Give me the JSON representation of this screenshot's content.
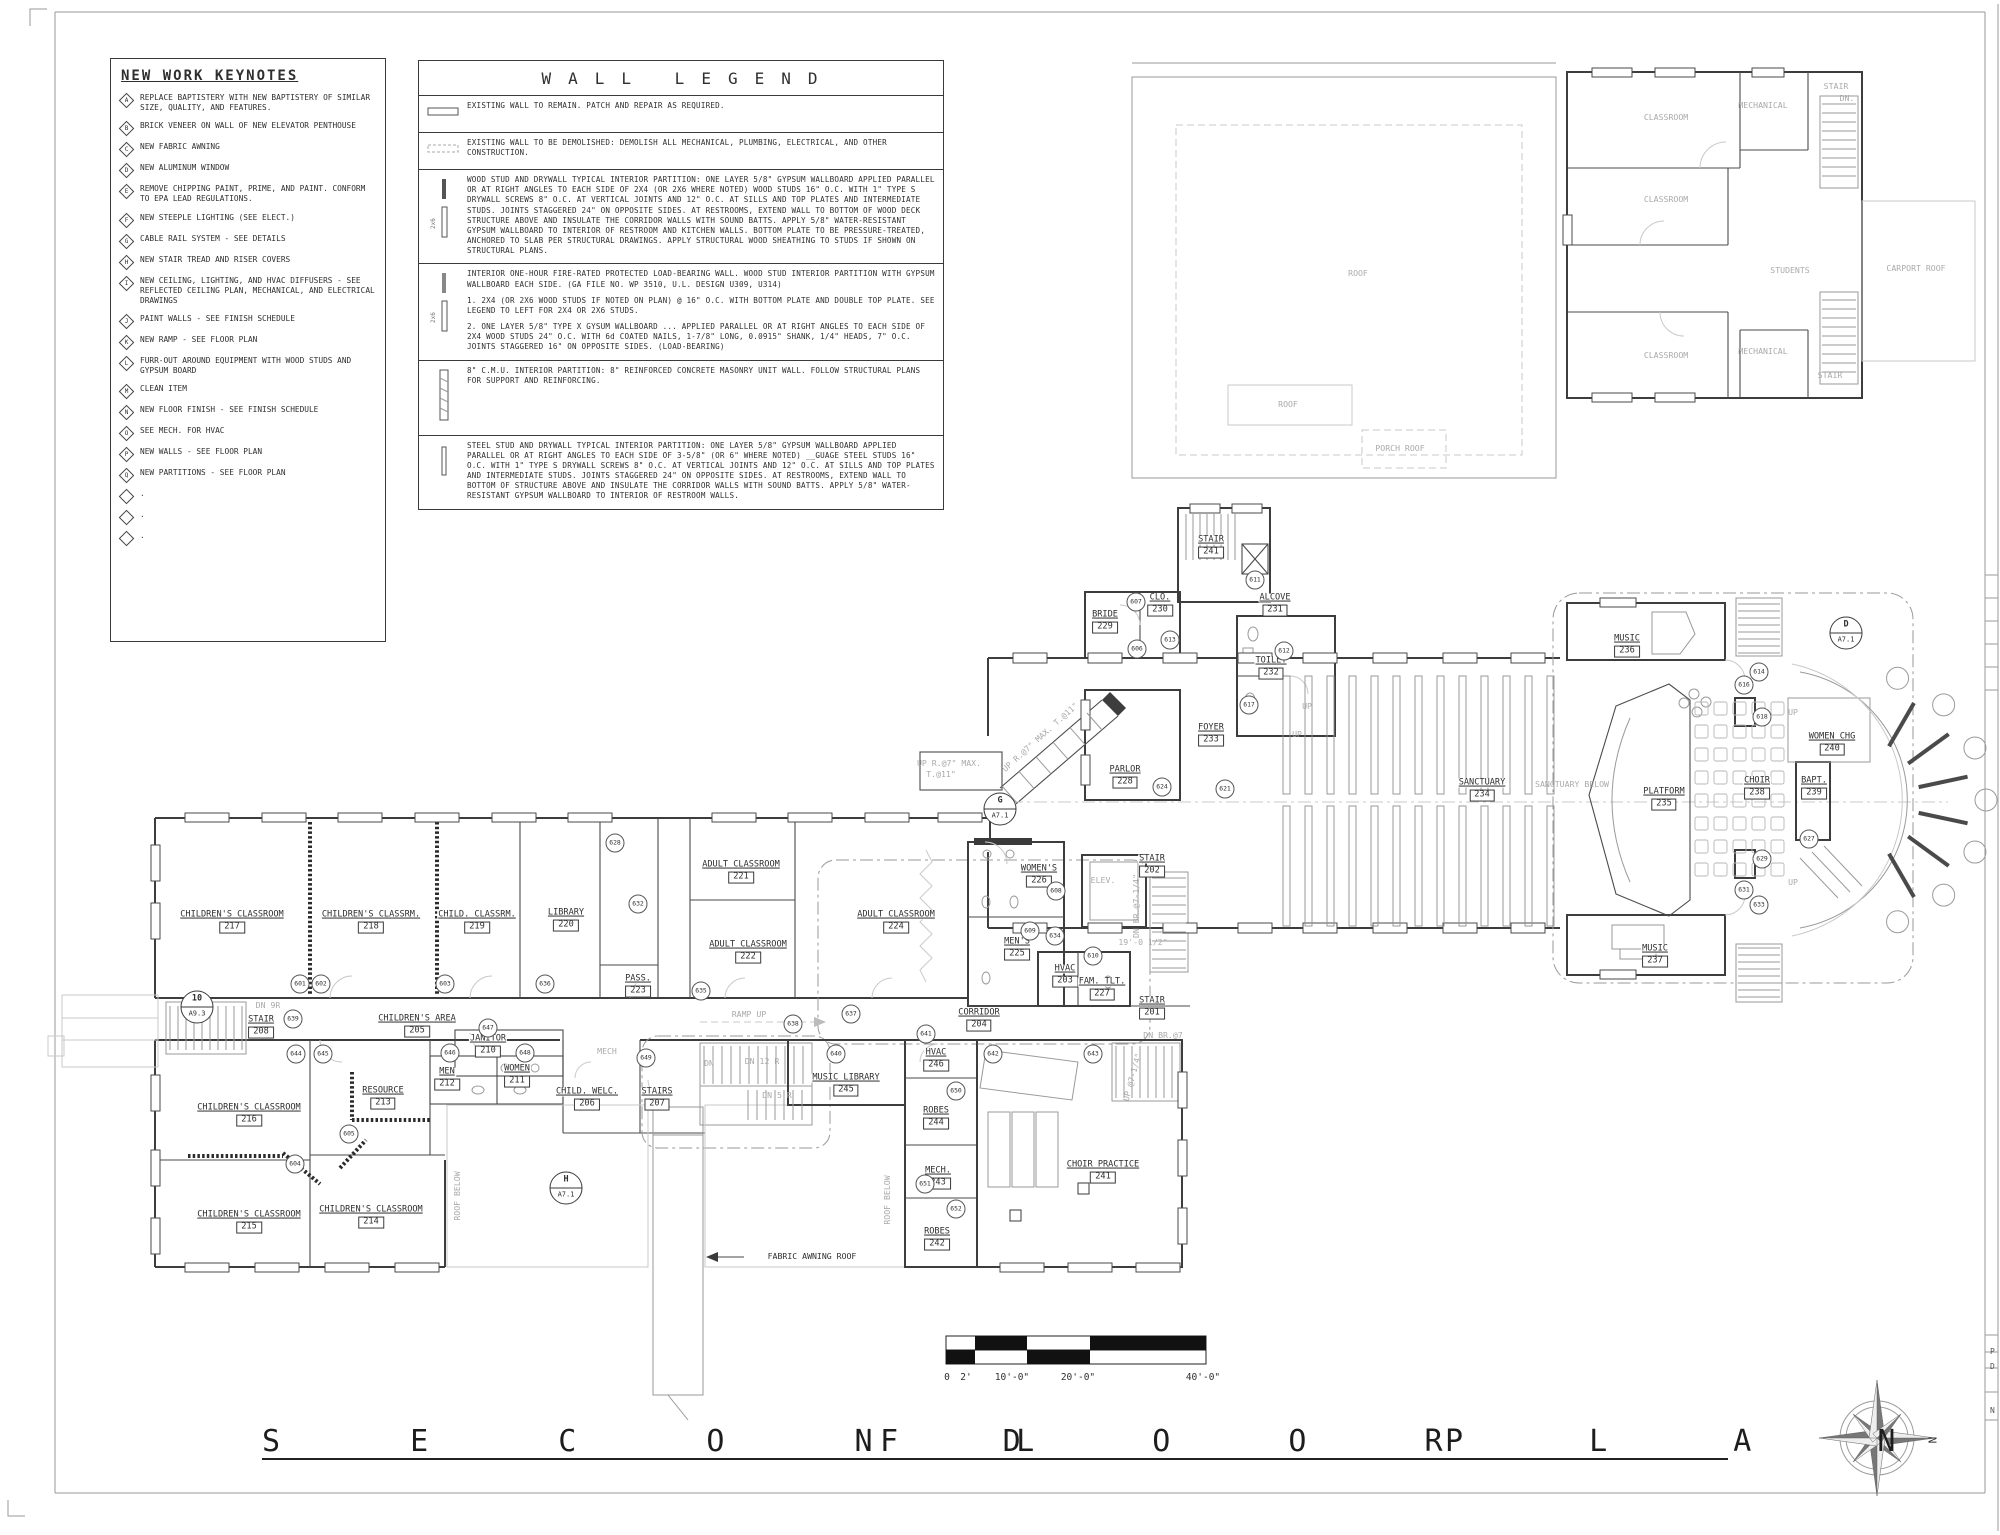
{
  "sheet": {
    "title": "SECOND FLOOR PLAN",
    "north_label": "N",
    "scale_bar": {
      "labels": [
        "0",
        "2'",
        "10'-0\"",
        "20'-0\"",
        "40'-0\""
      ]
    },
    "edge_letters": [
      "P",
      "D",
      "N"
    ]
  },
  "keynotes": {
    "title": "NEW WORK KEYNOTES",
    "items": [
      {
        "key": "A",
        "text": "REPLACE BAPTISTERY WITH NEW BAPTISTERY OF SIMILAR SIZE, QUALITY, AND FEATURES."
      },
      {
        "key": "B",
        "text": "BRICK VENEER ON WALL OF NEW ELEVATOR PENTHOUSE"
      },
      {
        "key": "C",
        "text": "NEW FABRIC AWNING"
      },
      {
        "key": "D",
        "text": "NEW ALUMINUM WINDOW"
      },
      {
        "key": "E",
        "text": "REMOVE CHIPPING PAINT, PRIME, AND PAINT. CONFORM TO EPA LEAD REGULATIONS."
      },
      {
        "key": "F",
        "text": "NEW STEEPLE LIGHTING (SEE ELECT.)"
      },
      {
        "key": "G",
        "text": "CABLE RAIL SYSTEM - SEE DETAILS"
      },
      {
        "key": "H",
        "text": "NEW STAIR TREAD AND RISER COVERS"
      },
      {
        "key": "I",
        "text": "NEW CEILING, LIGHTING, AND HVAC DIFFUSERS - SEE REFLECTED CEILING PLAN, MECHANICAL, AND ELECTRICAL DRAWINGS"
      },
      {
        "key": "J",
        "text": "PAINT WALLS - SEE FINISH SCHEDULE"
      },
      {
        "key": "K",
        "text": "NEW RAMP - SEE FLOOR PLAN"
      },
      {
        "key": "L",
        "text": "FURR-OUT AROUND EQUIPMENT WITH WOOD STUDS AND GYPSUM BOARD"
      },
      {
        "key": "M",
        "text": "CLEAN ITEM"
      },
      {
        "key": "N",
        "text": "NEW FLOOR FINISH - SEE FINISH SCHEDULE"
      },
      {
        "key": "O",
        "text": "SEE MECH. FOR HVAC"
      },
      {
        "key": "P",
        "text": "NEW WALLS - SEE FLOOR PLAN"
      },
      {
        "key": "Q",
        "text": "NEW PARTITIONS  - SEE FLOOR PLAN"
      },
      {
        "key": "",
        "text": "."
      },
      {
        "key": "",
        "text": "."
      },
      {
        "key": "",
        "text": "."
      }
    ]
  },
  "wall_legend": {
    "title": "WALL LEGEND",
    "entries": [
      {
        "id": "existing",
        "text": "EXISTING WALL TO REMAIN. PATCH AND REPAIR AS REQUIRED.",
        "sub": []
      },
      {
        "id": "demo",
        "text": "EXISTING WALL TO BE DEMOLISHED:  DEMOLISH ALL MECHANICAL, PLUMBING, ELECTRICAL, AND OTHER CONSTRUCTION.",
        "sub": []
      },
      {
        "id": "wood",
        "text": "WOOD STUD AND DRYWALL TYPICAL INTERIOR PARTITION: ONE LAYER 5/8\" GYPSUM  WALLBOARD APPLIED PARALLEL OR AT RIGHT ANGLES TO EACH SIDE OF 2X4 (OR 2X6 WHERE NOTED) WOOD STUDS 16\" O.C. WITH 1\" TYPE S DRYWALL SCREWS 8\" O.C. AT VERTICAL JOINTS AND 12\" O.C. AT SILLS AND TOP PLATES AND INTERMEDIATE STUDS. JOINTS STAGGERED 24\" ON OPPOSITE SIDES. AT RESTROOMS, EXTEND WALL TO BOTTOM OF WOOD DECK STRUCTURE ABOVE AND INSULATE THE CORRIDOR WALLS WITH SOUND BATTS.  APPLY 5/8\" WATER-RESISTANT GYPSUM WALLBOARD TO INTERIOR OF RESTROOM AND KITCHEN WALLS. BOTTOM PLATE TO BE PRESSURE-TREATED, ANCHORED TO SLAB PER STRUCTURAL DRAWINGS. APPLY STRUCTURAL WOOD SHEATHING TO STUDS IF SHOWN ON STRUCTURAL PLANS.",
        "sub": []
      },
      {
        "id": "fire",
        "text": "INTERIOR ONE-HOUR FIRE-RATED PROTECTED LOAD-BEARING WALL. WOOD STUD INTERIOR PARTITION WITH GYPSUM WALLBOARD EACH SIDE. (GA FILE NO. WP 3510, U.L. DESIGN U309, U314)",
        "sub": [
          "1. 2X4 (OR 2X6 WOOD STUDS IF NOTED ON PLAN) @ 16\" O.C. WITH BOTTOM PLATE AND DOUBLE TOP PLATE.  SEE LEGEND TO LEFT FOR 2X4 OR 2X6 STUDS.",
          "2. ONE LAYER 5/8\" TYPE X GYSUM WALLBOARD ... APPLIED PARALLEL OR AT RIGHT ANGLES TO EACH SIDE OF 2X4 WOOD STUDS 24\" O.C. WITH 6d COATED NAILS, 1-7/8\" LONG, 0.0915\" SHANK, 1/4\" HEADS, 7\" O.C.  JOINTS STAGGERED 16\" ON OPPOSITE SIDES. (LOAD-BEARING)"
        ]
      },
      {
        "id": "cmu",
        "text": "8\" C.M.U. INTERIOR PARTITION: 8\" REINFORCED CONCRETE MASONRY UNIT WALL.  FOLLOW STRUCTURAL PLANS FOR SUPPORT AND REINFORCING.",
        "sub": []
      },
      {
        "id": "steel",
        "text": "STEEL STUD AND DRYWALL TYPICAL INTERIOR PARTITION: ONE LAYER 5/8\" GYPSUM  WALLBOARD APPLIED PARALLEL OR AT RIGHT ANGLES TO EACH SIDE OF 3-5/8\" (OR 6\" WHERE NOTED) __GUAGE STEEL STUDS 16\" O.C. WITH 1\" TYPE S DRYWALL SCREWS 8\" O.C. AT VERTICAL JOINTS AND 12\" O.C. AT SILLS AND TOP PLATES AND INTERMEDIATE STUDS. JOINTS STAGGERED 24\" ON OPPOSITE SIDES. AT RESTROOMS, EXTEND WALL TO BOTTOM OF STRUCTURE ABOVE AND INSULATE THE CORRIDOR WALLS WITH SOUND BATTS.  APPLY 5/8\" WATER-RESISTANT GYPSUM WALLBOARD TO INTERIOR OF RESTROOM WALLS.",
        "sub": []
      }
    ]
  },
  "plan": {
    "rooms": [
      {
        "id": "r217",
        "name": "CHILDREN'S CLASSROOM",
        "number": "217"
      },
      {
        "id": "r218",
        "name": "CHILDREN'S CLASSRM.",
        "number": "218"
      },
      {
        "id": "r219",
        "name": "CHILD. CLASSRM.",
        "number": "219"
      },
      {
        "id": "r220",
        "name": "LIBRARY",
        "number": "220"
      },
      {
        "id": "r221",
        "name": "ADULT CLASSROOM",
        "number": "221"
      },
      {
        "id": "r222",
        "name": "ADULT CLASSROOM",
        "number": "222"
      },
      {
        "id": "r223",
        "name": "PASS.",
        "number": "223"
      },
      {
        "id": "r224",
        "name": "ADULT CLASSROOM",
        "number": "224"
      },
      {
        "id": "r225",
        "name": "MEN'S",
        "number": "225"
      },
      {
        "id": "r226",
        "name": "WOMEN'S",
        "number": "226"
      },
      {
        "id": "r202",
        "name": "STAIR",
        "number": "202"
      },
      {
        "id": "r203",
        "name": "HVAC",
        "number": "203"
      },
      {
        "id": "r227",
        "name": "FAM. TLT.",
        "number": "227"
      },
      {
        "id": "r201",
        "name": "STAIR",
        "number": "201"
      },
      {
        "id": "r204",
        "name": "CORRIDOR",
        "number": "204"
      },
      {
        "id": "r228",
        "name": "PARLOR",
        "number": "228"
      },
      {
        "id": "r229",
        "name": "BRIDE",
        "number": "229"
      },
      {
        "id": "r230",
        "name": "CLO.",
        "number": "230"
      },
      {
        "id": "r231",
        "name": "ALCOVE",
        "number": "231"
      },
      {
        "id": "r232",
        "name": "TOILET",
        "number": "232"
      },
      {
        "id": "r233",
        "name": "FOYER",
        "number": "233"
      },
      {
        "id": "r241-stair",
        "name": "STAIR",
        "number": "241"
      },
      {
        "id": "r234",
        "name": "SANCTUARY",
        "number": "234"
      },
      {
        "id": "r235",
        "name": "PLATFORM",
        "number": "235"
      },
      {
        "id": "r236",
        "name": "MUSIC",
        "number": "236"
      },
      {
        "id": "r237",
        "name": "MUSIC",
        "number": "237"
      },
      {
        "id": "r238",
        "name": "CHOIR",
        "number": "238"
      },
      {
        "id": "r239",
        "name": "BAPT.",
        "number": "239"
      },
      {
        "id": "r240",
        "name": "WOMEN CHG",
        "number": "240"
      },
      {
        "id": "r205",
        "name": "CHILDREN'S AREA",
        "number": "205"
      },
      {
        "id": "r208",
        "name": "STAIR",
        "number": "208"
      },
      {
        "id": "r210",
        "name": "JANITOR",
        "number": "210"
      },
      {
        "id": "r211",
        "name": "WOMEN",
        "number": "211"
      },
      {
        "id": "r212",
        "name": "MEN",
        "number": "212"
      },
      {
        "id": "r213",
        "name": "RESOURCE",
        "number": "213"
      },
      {
        "id": "r216",
        "name": "CHILDREN'S CLASSROOM",
        "number": "216"
      },
      {
        "id": "r206",
        "name": "CHILD. WELC.",
        "number": "206"
      },
      {
        "id": "r207",
        "name": "STAIRS",
        "number": "207"
      },
      {
        "id": "r215",
        "name": "CHILDREN'S CLASSROOM",
        "number": "215"
      },
      {
        "id": "r214",
        "name": "CHILDREN'S CLASSROOM",
        "number": "214"
      },
      {
        "id": "r245",
        "name": "MUSIC LIBRARY",
        "number": "245"
      },
      {
        "id": "r246",
        "name": "HVAC",
        "number": "246"
      },
      {
        "id": "r244",
        "name": "ROBES",
        "number": "244"
      },
      {
        "id": "r243",
        "name": "MECH.",
        "number": "243"
      },
      {
        "id": "r242",
        "name": "ROBES",
        "number": "242"
      },
      {
        "id": "r241-choir",
        "name": "CHOIR PRACTICE",
        "number": "241"
      }
    ],
    "labels": [
      {
        "id": "lbl-roof-main",
        "text": "ROOF"
      },
      {
        "id": "lbl-roof-small",
        "text": "ROOF"
      },
      {
        "id": "lbl-porch-roof",
        "text": "PORCH ROOF"
      },
      {
        "id": "lbl-classroom-1",
        "text": "CLASSROOM"
      },
      {
        "id": "lbl-classroom-2",
        "text": "CLASSROOM"
      },
      {
        "id": "lbl-classroom-3",
        "text": "CLASSROOM"
      },
      {
        "id": "lbl-mech-1",
        "text": "MECHANICAL"
      },
      {
        "id": "lbl-mech-2",
        "text": "MECHANICAL"
      },
      {
        "id": "lbl-stair-ne",
        "text": "STAIR"
      },
      {
        "id": "lbl-stair-se",
        "text": "STAIR"
      },
      {
        "id": "lbl-dn-ne",
        "text": "DN."
      },
      {
        "id": "lbl-students",
        "text": "STUDENTS"
      },
      {
        "id": "lbl-carport",
        "text": "CARPORT ROOF"
      },
      {
        "id": "lbl-elev",
        "text": "ELEV."
      },
      {
        "id": "lbl-sanct-below",
        "text": "SANCTUARY BELOW"
      },
      {
        "id": "lbl-roof-below-1",
        "text": "ROOF BELOW"
      },
      {
        "id": "lbl-roof-below-2",
        "text": "ROOF BELOW"
      },
      {
        "id": "lbl-ramp-up",
        "text": "RAMP UP"
      },
      {
        "id": "lbl-awning",
        "text": "FABRIC AWNING ROOF"
      },
      {
        "id": "lbl-mech-grey",
        "text": "MECH"
      },
      {
        "id": "lbl-up-1",
        "text": "UP"
      },
      {
        "id": "lbl-up-2",
        "text": "UP"
      },
      {
        "id": "lbl-up-3",
        "text": "UP"
      },
      {
        "id": "lbl-up-4",
        "text": "UP"
      },
      {
        "id": "lbl-dn12r",
        "text": "DN 12 R"
      },
      {
        "id": "lbl-dn5r",
        "text": "DN 5 R"
      },
      {
        "id": "lbl-dn9r",
        "text": "DN 9R"
      },
      {
        "id": "lbl-dn-st",
        "text": "DN"
      },
      {
        "id": "lbl-sn1",
        "text": "UP R.@7\" MAX."
      },
      {
        "id": "lbl-sn2",
        "text": "T.@11\""
      },
      {
        "id": "lbl-sn3",
        "text": "UP R.@7\" MAX. T.@11\""
      },
      {
        "id": "lbl-dnbr",
        "text": "DN BR.@7-1/4\""
      },
      {
        "id": "lbl-dim19",
        "text": "19'-0 1/2\""
      },
      {
        "id": "lbl-up714",
        "text": "UP @7-1/4\""
      },
      {
        "id": "lbl-dnbr7",
        "text": "DN BR.@7"
      }
    ],
    "keynote_bubbles": [
      "601",
      "602",
      "603",
      "604",
      "605",
      "606",
      "607",
      "608",
      "609",
      "610",
      "611",
      "612",
      "613",
      "614",
      "616",
      "617",
      "618",
      "621",
      "624",
      "627",
      "628",
      "629",
      "631",
      "632",
      "633",
      "634",
      "635",
      "636",
      "637",
      "638",
      "639",
      "640",
      "641",
      "642",
      "643",
      "644",
      "645",
      "646",
      "647",
      "648",
      "649",
      "650",
      "651",
      "652"
    ],
    "detail_markers": [
      {
        "id": "m-d",
        "ref": "D",
        "sheet": "A7.1"
      },
      {
        "id": "m-g",
        "ref": "G",
        "sheet": "A7.1"
      },
      {
        "id": "m-h",
        "ref": "H",
        "sheet": "A7.1"
      },
      {
        "id": "m-10",
        "ref": "10",
        "sheet": "A9.3"
      }
    ]
  },
  "colors": {
    "ink": "#2f2f2f",
    "grey": "#9a9a9a",
    "lightgrey": "#c9c9c9",
    "black_fill": "#111111"
  }
}
